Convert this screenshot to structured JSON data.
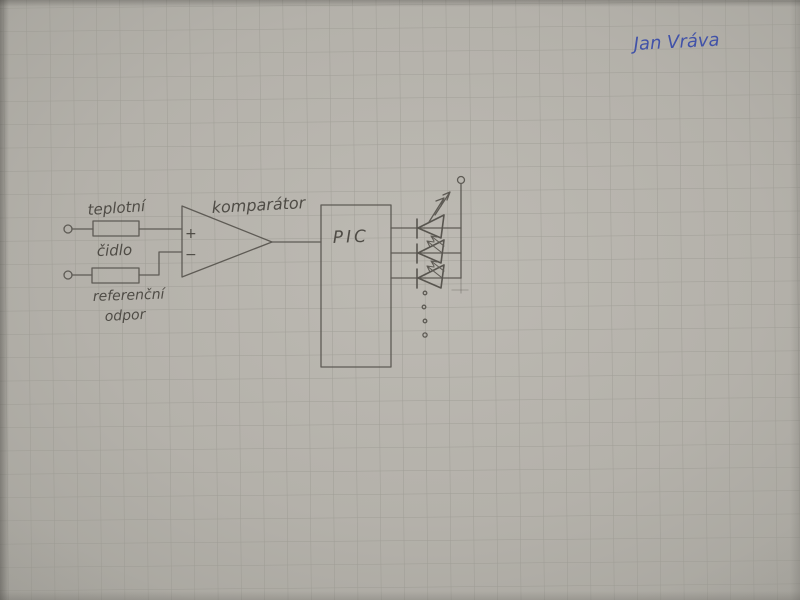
{
  "photo": {
    "signature": {
      "text": "Jan  Vráva"
    },
    "labels": {
      "sensor_top": "teplotní",
      "sensor_bottom": "čidlo",
      "reference_top": "referenční",
      "reference_bottom": "odpor",
      "comparator": "komparátor",
      "plus": "+",
      "minus": "−",
      "mcu": "PIC"
    },
    "colors": {
      "paper": "#b6b3ac",
      "grid_line": "#98968f",
      "pencil": "#55524c",
      "pen_blue": "#4152a8"
    },
    "components": [
      {
        "name": "input-terminal-top",
        "type": "open terminal circle"
      },
      {
        "name": "thermistor-resistor",
        "type": "resistor box",
        "label": "teplotní čidlo"
      },
      {
        "name": "input-terminal-bottom",
        "type": "open terminal circle"
      },
      {
        "name": "reference-resistor",
        "type": "resistor box",
        "label": "referenční odpor"
      },
      {
        "name": "comparator-triangle",
        "type": "op-amp comparator",
        "label": "komparátor",
        "inputs": [
          "+",
          "−"
        ]
      },
      {
        "name": "mcu-box",
        "type": "microcontroller rectangle",
        "label": "PIC"
      },
      {
        "name": "led-1",
        "type": "LED with emission arrows"
      },
      {
        "name": "led-2",
        "type": "LED with emission arrows"
      },
      {
        "name": "led-3",
        "type": "LED with emission arrows"
      },
      {
        "name": "more-leds-ellipsis",
        "type": "vertical dots"
      },
      {
        "name": "supply-terminal",
        "type": "terminal circle on vertical bus"
      }
    ]
  }
}
